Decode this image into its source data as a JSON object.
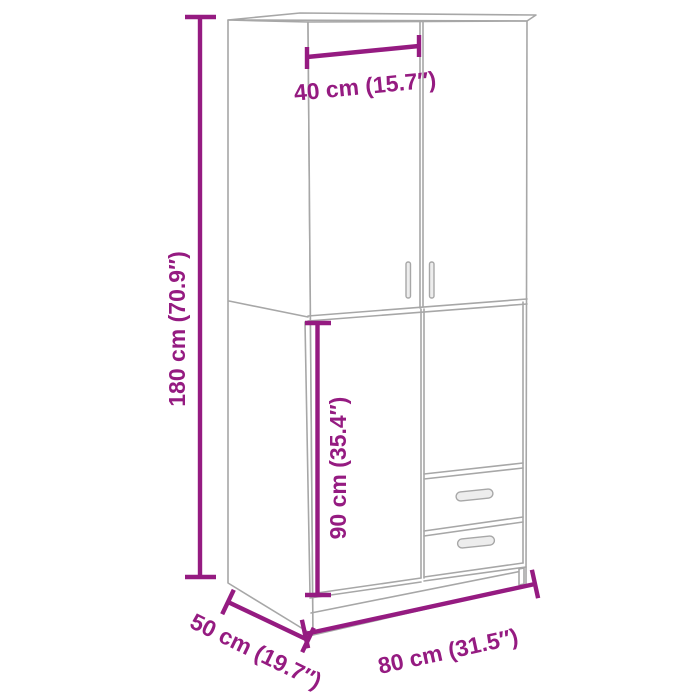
{
  "meta": {
    "description": "Product dimension diagram of a wardrobe with two upper doors, a lower door and two drawers"
  },
  "colors": {
    "accent": "#951b81",
    "drawing_line": "#a7a7a7",
    "background": "#ffffff"
  },
  "dimensions": {
    "door_width": {
      "label": "40 cm (15.7″)",
      "value_cm": 40,
      "value_in": 15.7
    },
    "height": {
      "label": "180 cm (70.9″)",
      "value_cm": 180,
      "value_in": 70.9
    },
    "lower_section_height": {
      "label": "90 cm (35.4″)",
      "value_cm": 90,
      "value_in": 35.4
    },
    "width": {
      "label": "80 cm (31.5″)",
      "value_cm": 80,
      "value_in": 31.5
    },
    "depth": {
      "label": "50 cm (19.7″)",
      "value_cm": 50,
      "value_in": 19.7
    }
  }
}
